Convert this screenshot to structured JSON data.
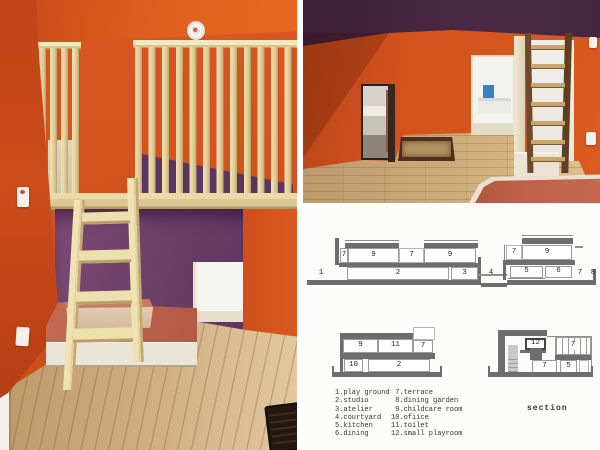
{
  "colors": {
    "orange_wall": "#d3521d",
    "purple_ceiling": "#44253f",
    "purple_loft_wall": "#6a3f68",
    "wood_slat": "#eddcaa",
    "wood_floor": "#cfae7e",
    "salmon_platform": "#bd624c",
    "drawing_gray": "#6d6d6d",
    "panel_background": "#fcfcfb"
  },
  "section_panel": {
    "drawings": {
      "top": {
        "labels": [
          "1",
          "7",
          "9",
          "7",
          "9",
          "2",
          "3",
          "4",
          "7",
          "9",
          "5",
          "6",
          "7",
          "8"
        ]
      },
      "bottom_left": {
        "labels": [
          "9",
          "11",
          "7",
          "10",
          "2"
        ]
      },
      "bottom_right": {
        "labels": [
          "12",
          "7",
          "7",
          "5"
        ]
      }
    },
    "legend": {
      "col1": [
        "1.play ground",
        "2.studio",
        "3.atelier",
        "4.courtyard",
        "5.kitchen",
        "6.dining"
      ],
      "col2": [
        " 7.terrace",
        " 8.dining garden",
        " 9.childcare room",
        "10.ofiice",
        "11.toilet",
        "12.small playroom"
      ]
    },
    "caption": "section"
  }
}
